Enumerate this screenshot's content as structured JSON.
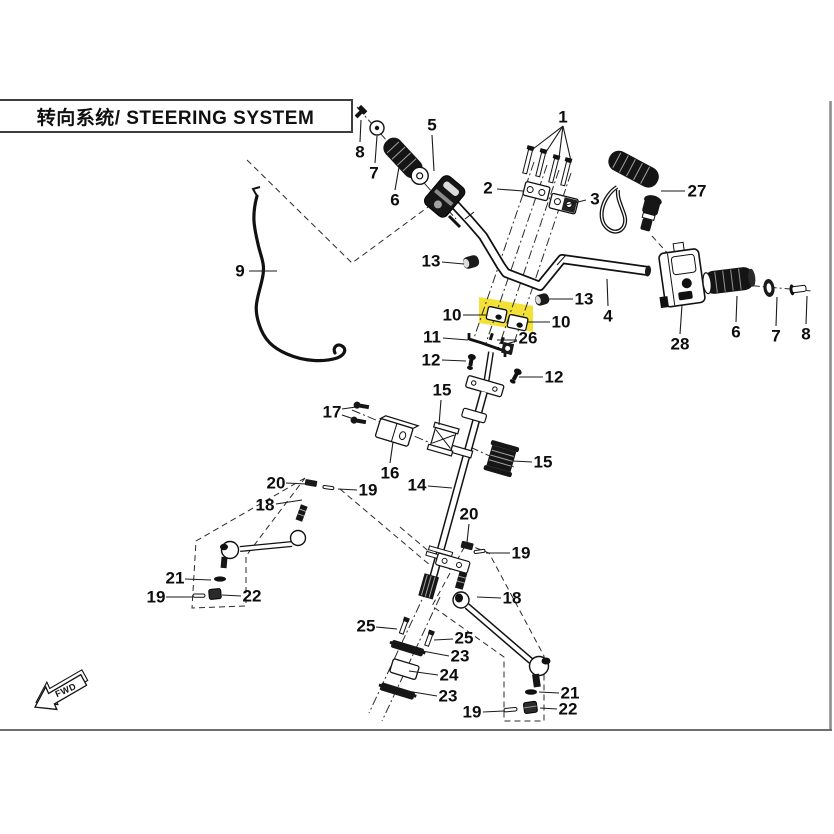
{
  "header": {
    "title": "转向系统/ STEERING SYSTEM"
  },
  "fwd": {
    "label": "FWD"
  },
  "highlight": {
    "color": "#f3e135",
    "parts": [
      "10",
      "26"
    ]
  },
  "callouts": [
    {
      "label": "1",
      "x": 563,
      "y": 117,
      "leaders": [
        [
          563,
          126,
          533,
          149
        ],
        [
          563,
          126,
          546,
          152
        ],
        [
          563,
          126,
          559,
          158
        ],
        [
          563,
          126,
          571,
          161
        ]
      ]
    },
    {
      "label": "2",
      "x": 488,
      "y": 188,
      "leaders": [
        [
          497,
          189,
          523,
          191
        ]
      ]
    },
    {
      "label": "3",
      "x": 595,
      "y": 199,
      "leaders": [
        [
          586,
          200,
          566,
          205
        ]
      ]
    },
    {
      "label": "4",
      "x": 608,
      "y": 316,
      "leaders": [
        [
          608,
          306,
          607,
          279
        ]
      ]
    },
    {
      "label": "5",
      "x": 432,
      "y": 125,
      "leaders": [
        [
          432,
          135,
          434,
          171
        ]
      ]
    },
    {
      "label": "6",
      "x": 395,
      "y": 200,
      "leaders": [
        [
          395,
          190,
          399,
          167
        ]
      ]
    },
    {
      "label": "7",
      "x": 374,
      "y": 173,
      "leaders": [
        [
          375,
          163,
          377,
          136
        ]
      ]
    },
    {
      "label": "8",
      "x": 360,
      "y": 152,
      "leaders": [
        [
          360,
          142,
          361,
          120
        ]
      ]
    },
    {
      "label": "9",
      "x": 240,
      "y": 271,
      "leaders": [
        [
          249,
          271,
          277,
          271
        ]
      ]
    },
    {
      "label": "27",
      "x": 697,
      "y": 191,
      "leaders": [
        [
          685,
          191,
          661,
          191
        ]
      ]
    },
    {
      "label": "28",
      "x": 680,
      "y": 344,
      "leaders": [
        [
          680,
          334,
          682,
          305
        ]
      ]
    },
    {
      "label": "6",
      "x": 736,
      "y": 332,
      "leaders": [
        [
          736,
          322,
          737,
          296
        ]
      ]
    },
    {
      "label": "7",
      "x": 776,
      "y": 336,
      "leaders": [
        [
          776,
          326,
          777,
          297
        ]
      ]
    },
    {
      "label": "8",
      "x": 806,
      "y": 334,
      "leaders": [
        [
          806,
          324,
          807,
          296
        ]
      ]
    },
    {
      "label": "13",
      "x": 431,
      "y": 261,
      "leaders": [
        [
          442,
          262,
          464,
          264
        ]
      ]
    },
    {
      "label": "13",
      "x": 584,
      "y": 299,
      "leaders": [
        [
          573,
          299,
          549,
          299
        ]
      ]
    },
    {
      "label": "10",
      "x": 452,
      "y": 315,
      "leaders": [
        [
          463,
          315,
          486,
          315
        ]
      ]
    },
    {
      "label": "10",
      "x": 561,
      "y": 322,
      "leaders": [
        [
          550,
          322,
          528,
          322
        ]
      ]
    },
    {
      "label": "26",
      "x": 528,
      "y": 338,
      "leaders": [
        [
          517,
          340,
          497,
          340
        ],
        [
          517,
          341,
          506,
          344
        ]
      ]
    },
    {
      "label": "11",
      "x": 432,
      "y": 337,
      "leaders": [
        [
          443,
          338,
          468,
          340
        ]
      ]
    },
    {
      "label": "12",
      "x": 431,
      "y": 360,
      "leaders": [
        [
          442,
          360,
          466,
          361
        ]
      ]
    },
    {
      "label": "12",
      "x": 554,
      "y": 377,
      "leaders": [
        [
          543,
          377,
          519,
          377
        ]
      ]
    },
    {
      "label": "15",
      "x": 442,
      "y": 390,
      "leaders": [
        [
          441,
          400,
          439,
          425
        ]
      ]
    },
    {
      "label": "17",
      "x": 332,
      "y": 412,
      "leaders": [
        [
          342,
          409,
          356,
          407
        ],
        [
          342,
          415,
          354,
          419
        ]
      ]
    },
    {
      "label": "16",
      "x": 390,
      "y": 473,
      "leaders": [
        [
          390,
          463,
          393,
          442
        ]
      ]
    },
    {
      "label": "15",
      "x": 543,
      "y": 462,
      "leaders": [
        [
          532,
          462,
          513,
          461
        ]
      ]
    },
    {
      "label": "14",
      "x": 417,
      "y": 485,
      "leaders": [
        [
          428,
          486,
          452,
          488
        ]
      ]
    },
    {
      "label": "20",
      "x": 276,
      "y": 483,
      "leaders": [
        [
          286,
          483,
          306,
          484
        ]
      ]
    },
    {
      "label": "19",
      "x": 368,
      "y": 490,
      "leaders": [
        [
          357,
          490,
          338,
          489
        ]
      ]
    },
    {
      "label": "18",
      "x": 265,
      "y": 505,
      "leaders": [
        [
          276,
          504,
          302,
          500
        ]
      ]
    },
    {
      "label": "21",
      "x": 175,
      "y": 578,
      "leaders": [
        [
          185,
          579,
          211,
          580
        ]
      ]
    },
    {
      "label": "19",
      "x": 156,
      "y": 597,
      "leaders": [
        [
          166,
          597,
          193,
          597
        ]
      ]
    },
    {
      "label": "22",
      "x": 252,
      "y": 596,
      "leaders": [
        [
          241,
          596,
          222,
          595
        ]
      ]
    },
    {
      "label": "20",
      "x": 469,
      "y": 514,
      "leaders": [
        [
          469,
          524,
          467,
          542
        ]
      ]
    },
    {
      "label": "19",
      "x": 521,
      "y": 553,
      "leaders": [
        [
          510,
          553,
          486,
          553
        ]
      ]
    },
    {
      "label": "18",
      "x": 512,
      "y": 598,
      "leaders": [
        [
          501,
          598,
          477,
          597
        ]
      ]
    },
    {
      "label": "25",
      "x": 366,
      "y": 626,
      "leaders": [
        [
          376,
          627,
          397,
          629
        ]
      ]
    },
    {
      "label": "25",
      "x": 464,
      "y": 638,
      "leaders": [
        [
          453,
          639,
          434,
          640
        ]
      ]
    },
    {
      "label": "23",
      "x": 460,
      "y": 656,
      "leaders": [
        [
          449,
          656,
          417,
          650
        ]
      ]
    },
    {
      "label": "24",
      "x": 449,
      "y": 675,
      "leaders": [
        [
          438,
          675,
          409,
          671
        ]
      ]
    },
    {
      "label": "23",
      "x": 448,
      "y": 696,
      "leaders": [
        [
          437,
          696,
          407,
          691
        ]
      ]
    },
    {
      "label": "21",
      "x": 570,
      "y": 693,
      "leaders": [
        [
          559,
          693,
          539,
          692
        ]
      ]
    },
    {
      "label": "22",
      "x": 568,
      "y": 709,
      "leaders": [
        [
          557,
          709,
          540,
          708
        ]
      ]
    },
    {
      "label": "19",
      "x": 472,
      "y": 712,
      "leaders": [
        [
          483,
          712,
          504,
          711
        ]
      ]
    }
  ]
}
